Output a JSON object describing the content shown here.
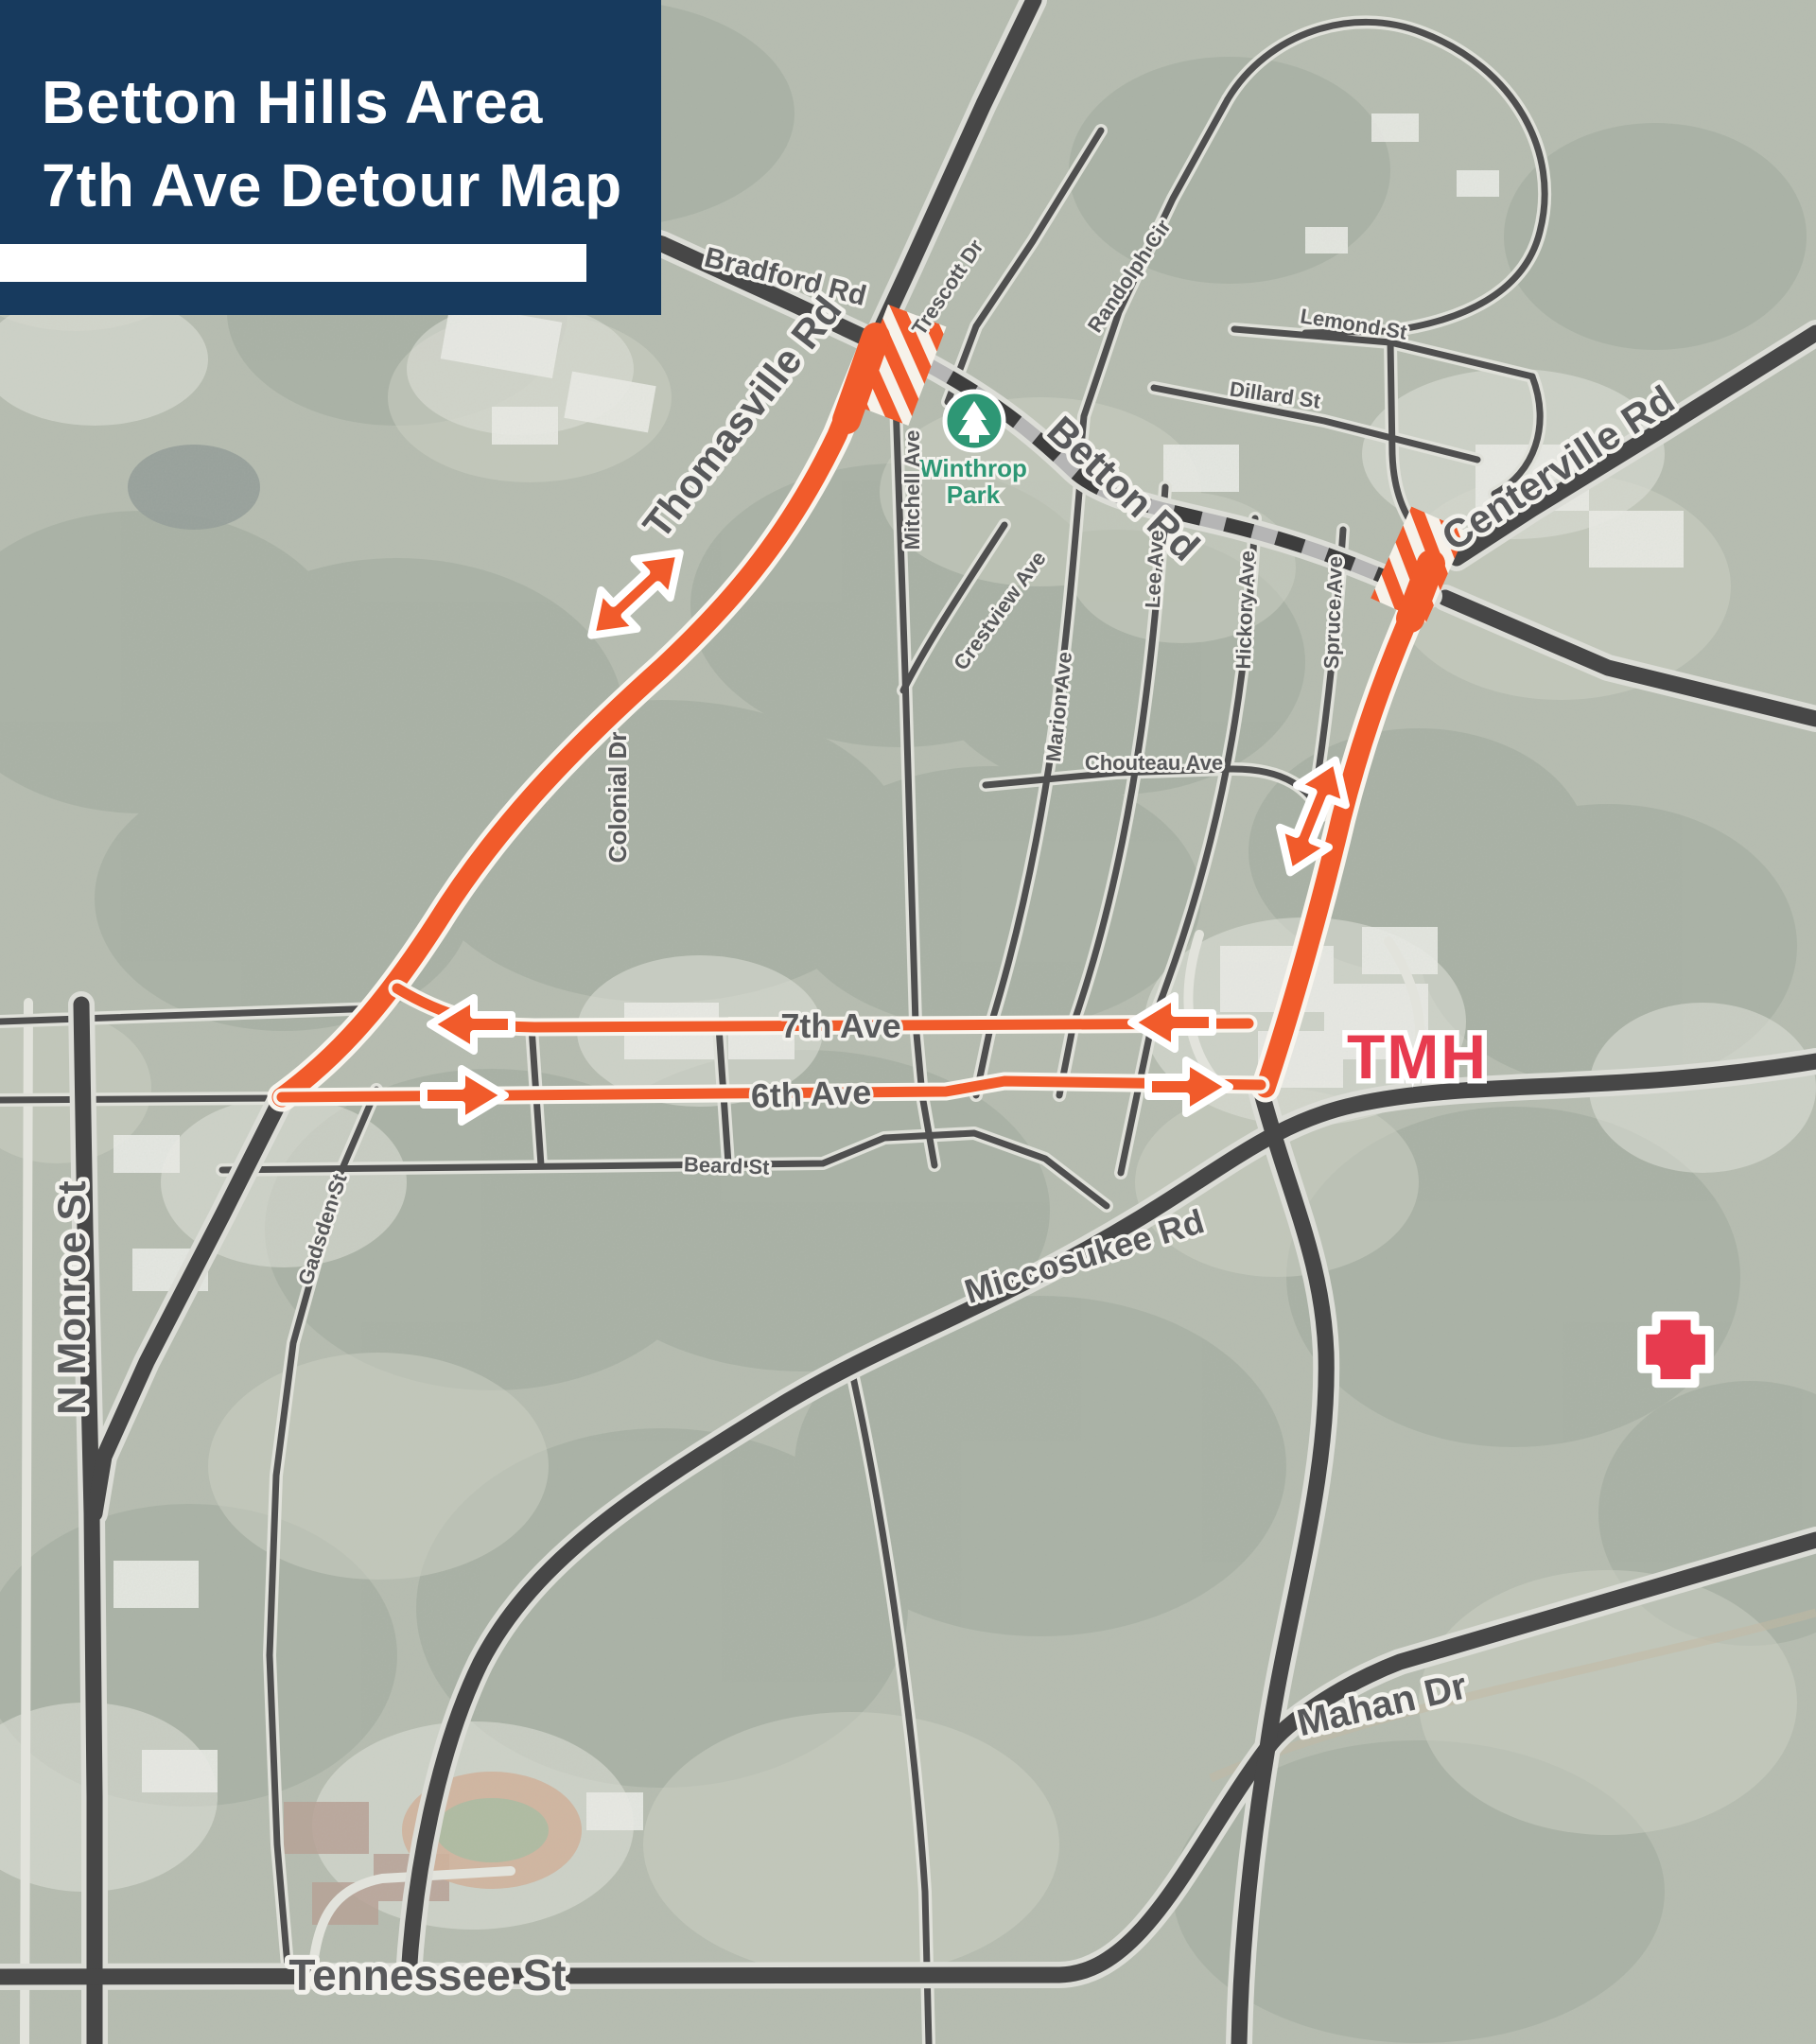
{
  "title": {
    "line1": "Betton Hills Area",
    "line2": "7th Ave Detour Map"
  },
  "colors": {
    "title_navy": "#173A5E",
    "detour_orange": "#F15B2B",
    "road_dark": "#474747",
    "road_casing": "#DCDDD7",
    "closed_dash_gray": "#B5B5B5",
    "label_gray": "#58595B",
    "tmh_red": "#E73B4F",
    "park_green": "#2E9775",
    "background_sage": "#A7AFA0"
  },
  "icons": {
    "park": "tree-icon",
    "hospital": "red-cross-icon",
    "closure": "striped-closure-hatch",
    "two_way_detour": "double-headed-arrow",
    "one_way_detour": "single-arrow"
  },
  "roads": {
    "bradford": "Bradford Rd",
    "thomasville": "Thomasville Rd",
    "betton": "Betton Rd",
    "centerville": "Centerville Rd",
    "mitchell": "Mitchell Ave",
    "trescott": "Trescott Dr",
    "randolph": "Randolph Cir",
    "lemond": "Lemond St",
    "dillard": "Dillard St",
    "crestview": "Crestview Ave",
    "marion": "Marion Ave",
    "lee": "Lee Ave",
    "hickory": "Hickory Ave",
    "spruce": "Spruce Ave",
    "chouteau": "Chouteau Ave",
    "colonial": "Colonial Dr",
    "seventh": "7th Ave",
    "sixth": "6th Ave",
    "beard": "Beard St",
    "gadsden": "Gadsden St",
    "monroe": "N Monroe St",
    "miccosukee": "Miccosukee Rd",
    "mahan": "Mahan Dr",
    "tennessee": "Tennessee St"
  },
  "poi": {
    "winthrop_line1": "Winthrop",
    "winthrop_line2": "Park",
    "tmh": "TMH"
  }
}
